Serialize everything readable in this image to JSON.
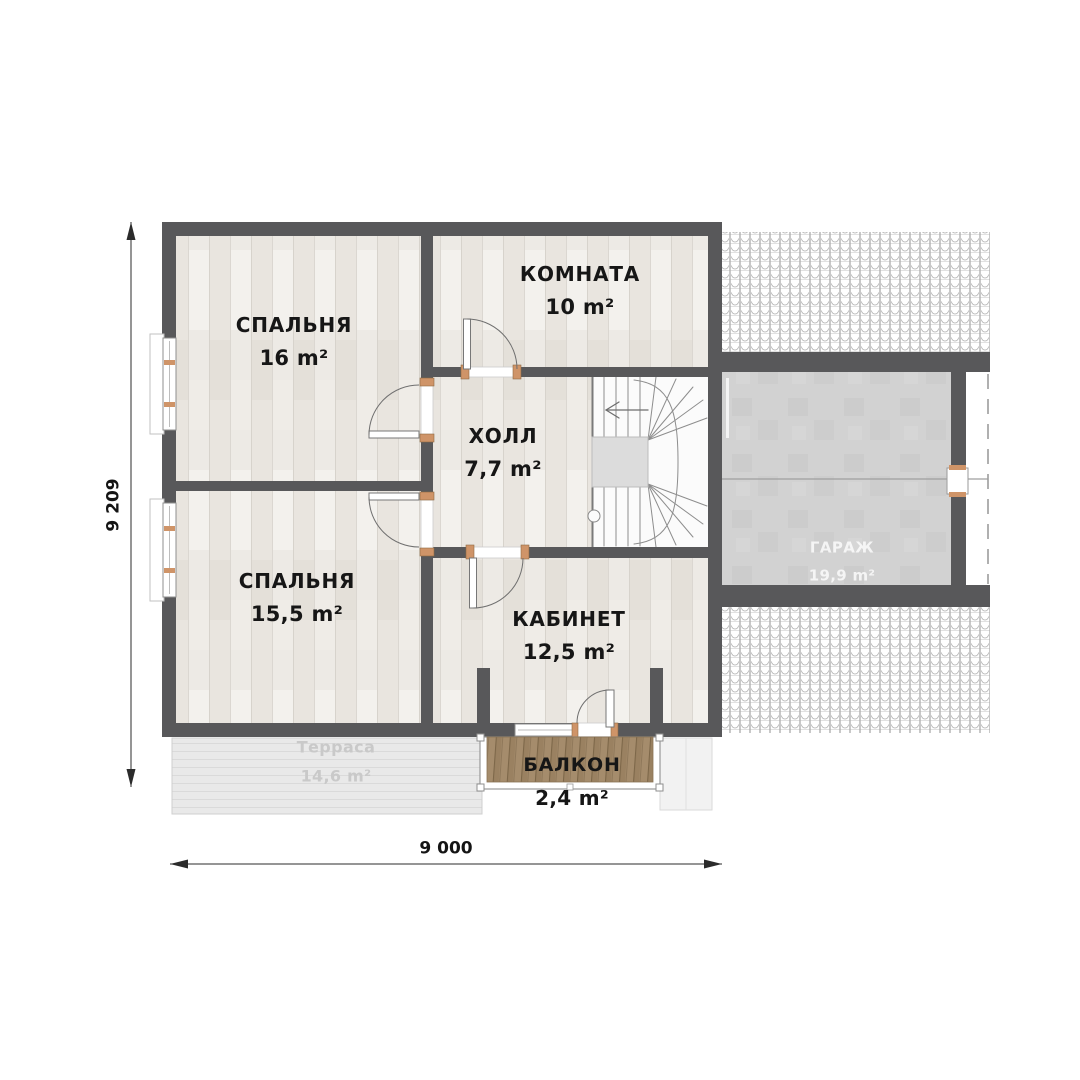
{
  "plan": {
    "rooms": [
      {
        "id": "bedroom-top",
        "name": "СПАЛЬНЯ",
        "area": "16 m²"
      },
      {
        "id": "room",
        "name": "КОМНАТА",
        "area": "10 m²"
      },
      {
        "id": "hall",
        "name": "ХОЛЛ",
        "area": "7,7 m²"
      },
      {
        "id": "bedroom-bottom",
        "name": "СПАЛЬНЯ",
        "area": "15,5 m²"
      },
      {
        "id": "study",
        "name": "КАБИНЕТ",
        "area": "12,5 m²"
      },
      {
        "id": "balcony",
        "name": "БАЛКОН",
        "area": "2,4 m²"
      },
      {
        "id": "terrace",
        "name": "Терраса",
        "area": "14,6 m²"
      },
      {
        "id": "garage",
        "name": "ГАРАЖ",
        "area": "19,9 m²"
      }
    ],
    "dimensions": {
      "horizontal": "9 000",
      "vertical": "9 209"
    },
    "colors": {
      "wall": "#58585a",
      "floor_wood": "#edeae5",
      "stair_floor": "#fbfbfb",
      "stair_void": "#dcdcdc",
      "garage_floor": "#d2d2d2",
      "terrace": "#e9e9e9",
      "deck_wood": "#a58c6c",
      "hinge_accent": "#cf9468",
      "roof_hatch_line": "#b0b0b0",
      "dimension_line": "#2b2b2b"
    }
  }
}
